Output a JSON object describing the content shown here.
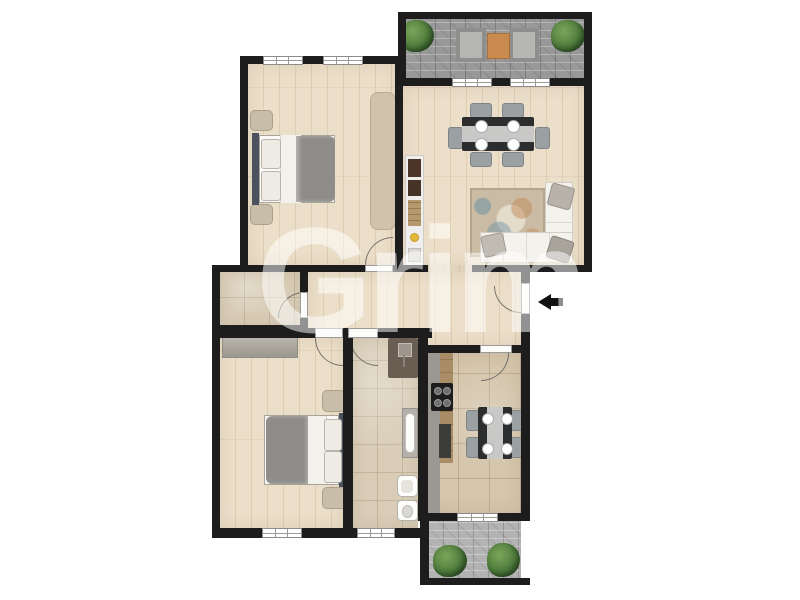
{
  "watermark": {
    "text": "Grim"
  },
  "entrance": {
    "arrow_icon": "arrow-left"
  },
  "palette": {
    "wall": "#1d1d1d",
    "watermark": "rgba(255,255,255,0.52)",
    "wood_floor": "#ecdfc9",
    "wood_line": "rgba(160,120,80,0.18)",
    "stone_floor": "#d9cdb7",
    "kitchen_floor": "#d4c5ab",
    "paving_dark": "#999999",
    "paving_light": "#b3b3b3",
    "duvet": "#8f8d89",
    "headboard": "#4a5260",
    "couch": "#f4f2ec",
    "rug_base": "#cabca4",
    "rug_bedroom": "#cfc3ac",
    "mat": "#c8bda8",
    "wardrobe": "#a9a59c",
    "table_dark": "#2b2d2f",
    "runner": "#c8c8c6",
    "chair": "#9ba0a3",
    "plant": "#4e7c3c",
    "terrace_table": "#c98a4e",
    "shower": "#6a5e53",
    "counter_wood": "#a98d67",
    "counter_gray": "#9b9892",
    "stove": "#1d1d1d",
    "arrow": "#111111"
  },
  "rooms": [
    {
      "id": "terrace-top",
      "label": "terrace",
      "furniture": [
        "armchair",
        "armchair",
        "side-table",
        "plant",
        "plant"
      ],
      "windows": 0
    },
    {
      "id": "bedroom-1",
      "label": "bedroom",
      "furniture": [
        "double-bed",
        "bedside-mat",
        "bedside-mat",
        "rug"
      ],
      "windows": 2
    },
    {
      "id": "living-room",
      "label": "living-dining-room",
      "furniture": [
        "dining-table",
        "6-chairs",
        "corner-sofa",
        "patterned-rug",
        "sideboard"
      ],
      "windows": 2
    },
    {
      "id": "hallway",
      "label": "hallway",
      "furniture": [],
      "windows": 0
    },
    {
      "id": "storage",
      "label": "storage-room",
      "furniture": [],
      "windows": 0
    },
    {
      "id": "bedroom-2",
      "label": "bedroom",
      "furniture": [
        "double-bed",
        "wardrobe",
        "bedside-mat",
        "bedside-mat"
      ],
      "windows": 1
    },
    {
      "id": "bathroom",
      "label": "bathroom",
      "furniture": [
        "shower",
        "sink",
        "bidet",
        "toilet"
      ],
      "windows": 1
    },
    {
      "id": "kitchen",
      "label": "kitchen",
      "furniture": [
        "counter",
        "stove",
        "dining-table",
        "4-chairs"
      ],
      "windows": 1
    },
    {
      "id": "balcony-bottom",
      "label": "balcony",
      "furniture": [
        "plant",
        "plant"
      ],
      "windows": 0
    }
  ]
}
